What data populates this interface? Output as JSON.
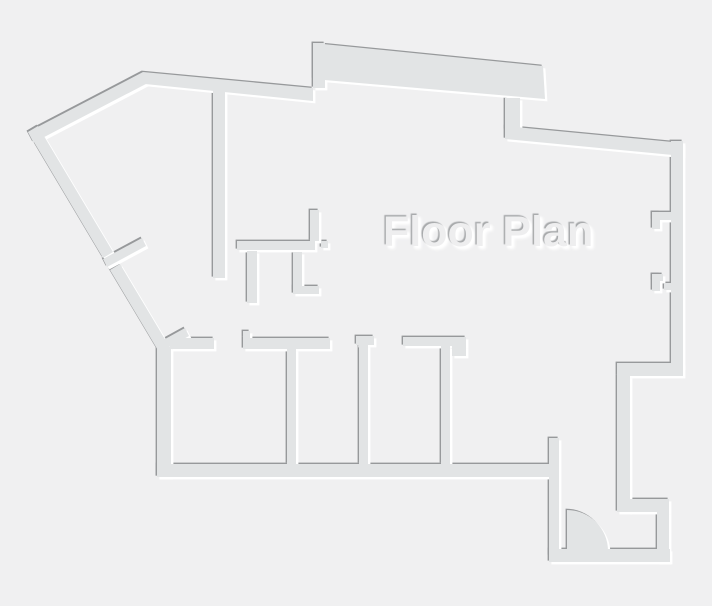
{
  "title": "Floor Plan",
  "colors": {
    "background": "#f0f0f1",
    "wall": "#e2e4e5",
    "shadow": "#97999b",
    "highlight": "#ffffff",
    "title_fill": "#eeeeef",
    "title_shadow_dark": "#a7a9ab",
    "title_shadow_light": "#ffffff"
  },
  "canvas": {
    "width": 712,
    "height": 606
  },
  "plan": {
    "emboss": {
      "dark_offset": -1.4,
      "light_offset": 2.4
    },
    "rects": [
      {
        "name": "wall-protrusion-left-step",
        "x": 313,
        "y": 43,
        "w": 12,
        "h": 45
      },
      {
        "name": "wall-top-connector",
        "x": 505,
        "y": 98,
        "w": 15,
        "h": 32
      },
      {
        "name": "wall-right",
        "x": 671,
        "y": 141,
        "w": 12,
        "h": 227
      },
      {
        "name": "wall-right-step",
        "x": 617,
        "y": 363,
        "w": 66,
        "h": 13
      },
      {
        "name": "wall-lower-right",
        "x": 617,
        "y": 376,
        "w": 13,
        "h": 136
      },
      {
        "name": "wall-alcove-top",
        "x": 628,
        "y": 499,
        "w": 41,
        "h": 13
      },
      {
        "name": "wall-alcove-right",
        "x": 657,
        "y": 512,
        "w": 12,
        "h": 50
      },
      {
        "name": "wall-alcove-bottom",
        "x": 549,
        "y": 549,
        "w": 121,
        "h": 13
      },
      {
        "name": "wall-alcove-left",
        "x": 549,
        "y": 438,
        "w": 10,
        "h": 118
      },
      {
        "name": "wall-bottom",
        "x": 157,
        "y": 464,
        "w": 394,
        "h": 13
      },
      {
        "name": "wall-left",
        "x": 157,
        "y": 347,
        "w": 14,
        "h": 130
      },
      {
        "name": "wall-room-top-1",
        "x": 170,
        "y": 338,
        "w": 44,
        "h": 11
      },
      {
        "name": "wall-door-jamb",
        "x": 243,
        "y": 331,
        "w": 7,
        "h": 7
      },
      {
        "name": "wall-room-top-2",
        "x": 243,
        "y": 338,
        "w": 87,
        "h": 11
      },
      {
        "name": "wall-divider-a",
        "x": 287,
        "y": 349,
        "w": 9,
        "h": 115
      },
      {
        "name": "wall-room-top-3",
        "x": 356,
        "y": 336,
        "w": 18,
        "h": 9
      },
      {
        "name": "wall-divider-b",
        "x": 359,
        "y": 345,
        "w": 9,
        "h": 119
      },
      {
        "name": "wall-room-top-4",
        "x": 403,
        "y": 337,
        "w": 63,
        "h": 9
      },
      {
        "name": "wall-corner-block",
        "x": 452,
        "y": 346,
        "w": 14,
        "h": 10
      },
      {
        "name": "wall-divider-c",
        "x": 441,
        "y": 346,
        "w": 9,
        "h": 118
      },
      {
        "name": "wall-center-vertical",
        "x": 213,
        "y": 88,
        "w": 12,
        "h": 190
      },
      {
        "name": "wall-kitchen-horizontal",
        "x": 237,
        "y": 241,
        "w": 78,
        "h": 9
      },
      {
        "name": "wall-kitchen-stub",
        "x": 310,
        "y": 210,
        "w": 9,
        "h": 31
      },
      {
        "name": "wall-kitchen-cap",
        "x": 321,
        "y": 241,
        "w": 7,
        "h": 7
      },
      {
        "name": "wall-kitchen-vertical-1",
        "x": 247,
        "y": 251,
        "w": 10,
        "h": 52
      },
      {
        "name": "wall-kitchen-vertical-2",
        "x": 293,
        "y": 252,
        "w": 9,
        "h": 39
      },
      {
        "name": "wall-kitchen-foot",
        "x": 293,
        "y": 286,
        "w": 26,
        "h": 8
      },
      {
        "name": "wall-notch1-bar",
        "x": 652,
        "y": 212,
        "w": 21,
        "h": 8
      },
      {
        "name": "wall-notch1-leg",
        "x": 652,
        "y": 212,
        "w": 8,
        "h": 17
      },
      {
        "name": "wall-notch2-leg",
        "x": 652,
        "y": 274,
        "w": 8,
        "h": 17
      },
      {
        "name": "wall-notch2-bar",
        "x": 652,
        "y": 274,
        "w": 11,
        "h": 7
      },
      {
        "name": "wall-notch2-stub",
        "x": 664,
        "y": 283,
        "w": 10,
        "h": 7
      }
    ],
    "polys": [
      {
        "name": "wall-diagonal-top",
        "points": "28,132 143,72 148.5,82.6 33.5,142.6"
      },
      {
        "name": "wall-top",
        "points": "143,72 313,88 313,101 145,84"
      },
      {
        "name": "wall-protrusion",
        "points": "313,43 543,66 545,99 313,79"
      },
      {
        "name": "wall-top-right",
        "points": "505,126 683,143 683,156 505,139"
      },
      {
        "name": "wall-diagonal-left-a",
        "points": "28,132 103,258 113,252 38,126"
      },
      {
        "name": "wall-diagonal-left-b",
        "points": "110,270 159,352 169,346 120,264"
      },
      {
        "name": "wall-diagonal-stub-1",
        "points": "103,259 142,238 146,246 107,267"
      },
      {
        "name": "wall-diagonal-stub-2",
        "points": "156,344 185,328 189,336 160,352"
      }
    ],
    "door": {
      "name": "door-swing-arc",
      "cx": 567,
      "cy": 551,
      "r": 41
    }
  }
}
